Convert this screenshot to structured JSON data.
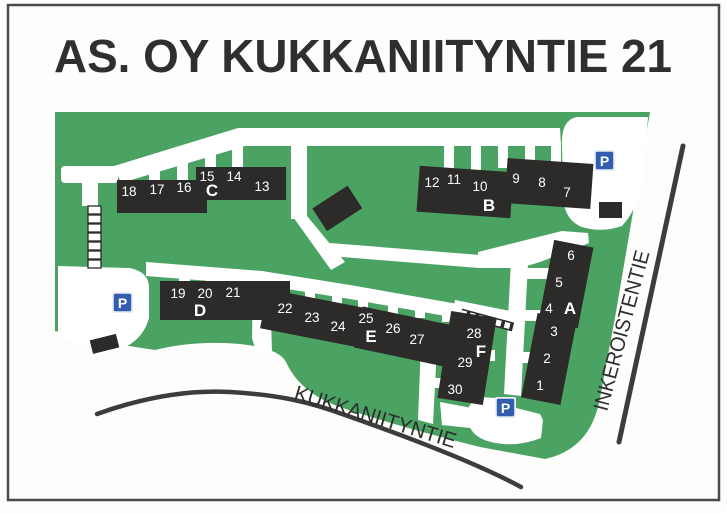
{
  "title": "AS. OY KUKKANIITYNTIE 21",
  "map": {
    "streets": {
      "bottom": "KUKKANIITYNTIE",
      "right": "INKEROISTENTIE"
    },
    "parking_label": "P",
    "buildings": {
      "A": {
        "label": "A",
        "units": [
          "6",
          "5",
          "4",
          "3",
          "2",
          "1"
        ]
      },
      "B": {
        "label": "B",
        "units": [
          "12",
          "11",
          "10",
          "9",
          "8",
          "7"
        ]
      },
      "C": {
        "label": "C",
        "units": [
          "18",
          "17",
          "16",
          "15",
          "14",
          "13"
        ]
      },
      "D": {
        "label": "D",
        "units": [
          "19",
          "20",
          "21"
        ]
      },
      "E": {
        "label": "E",
        "units": [
          "22",
          "23",
          "24",
          "25",
          "26",
          "27"
        ]
      },
      "F": {
        "label": "F",
        "units": [
          "28",
          "29",
          "30"
        ]
      }
    },
    "colors": {
      "green": "#4ba363",
      "building": "#2d2b29",
      "parking_blue": "#335eb0",
      "road_line": "#3c3c3c"
    }
  }
}
